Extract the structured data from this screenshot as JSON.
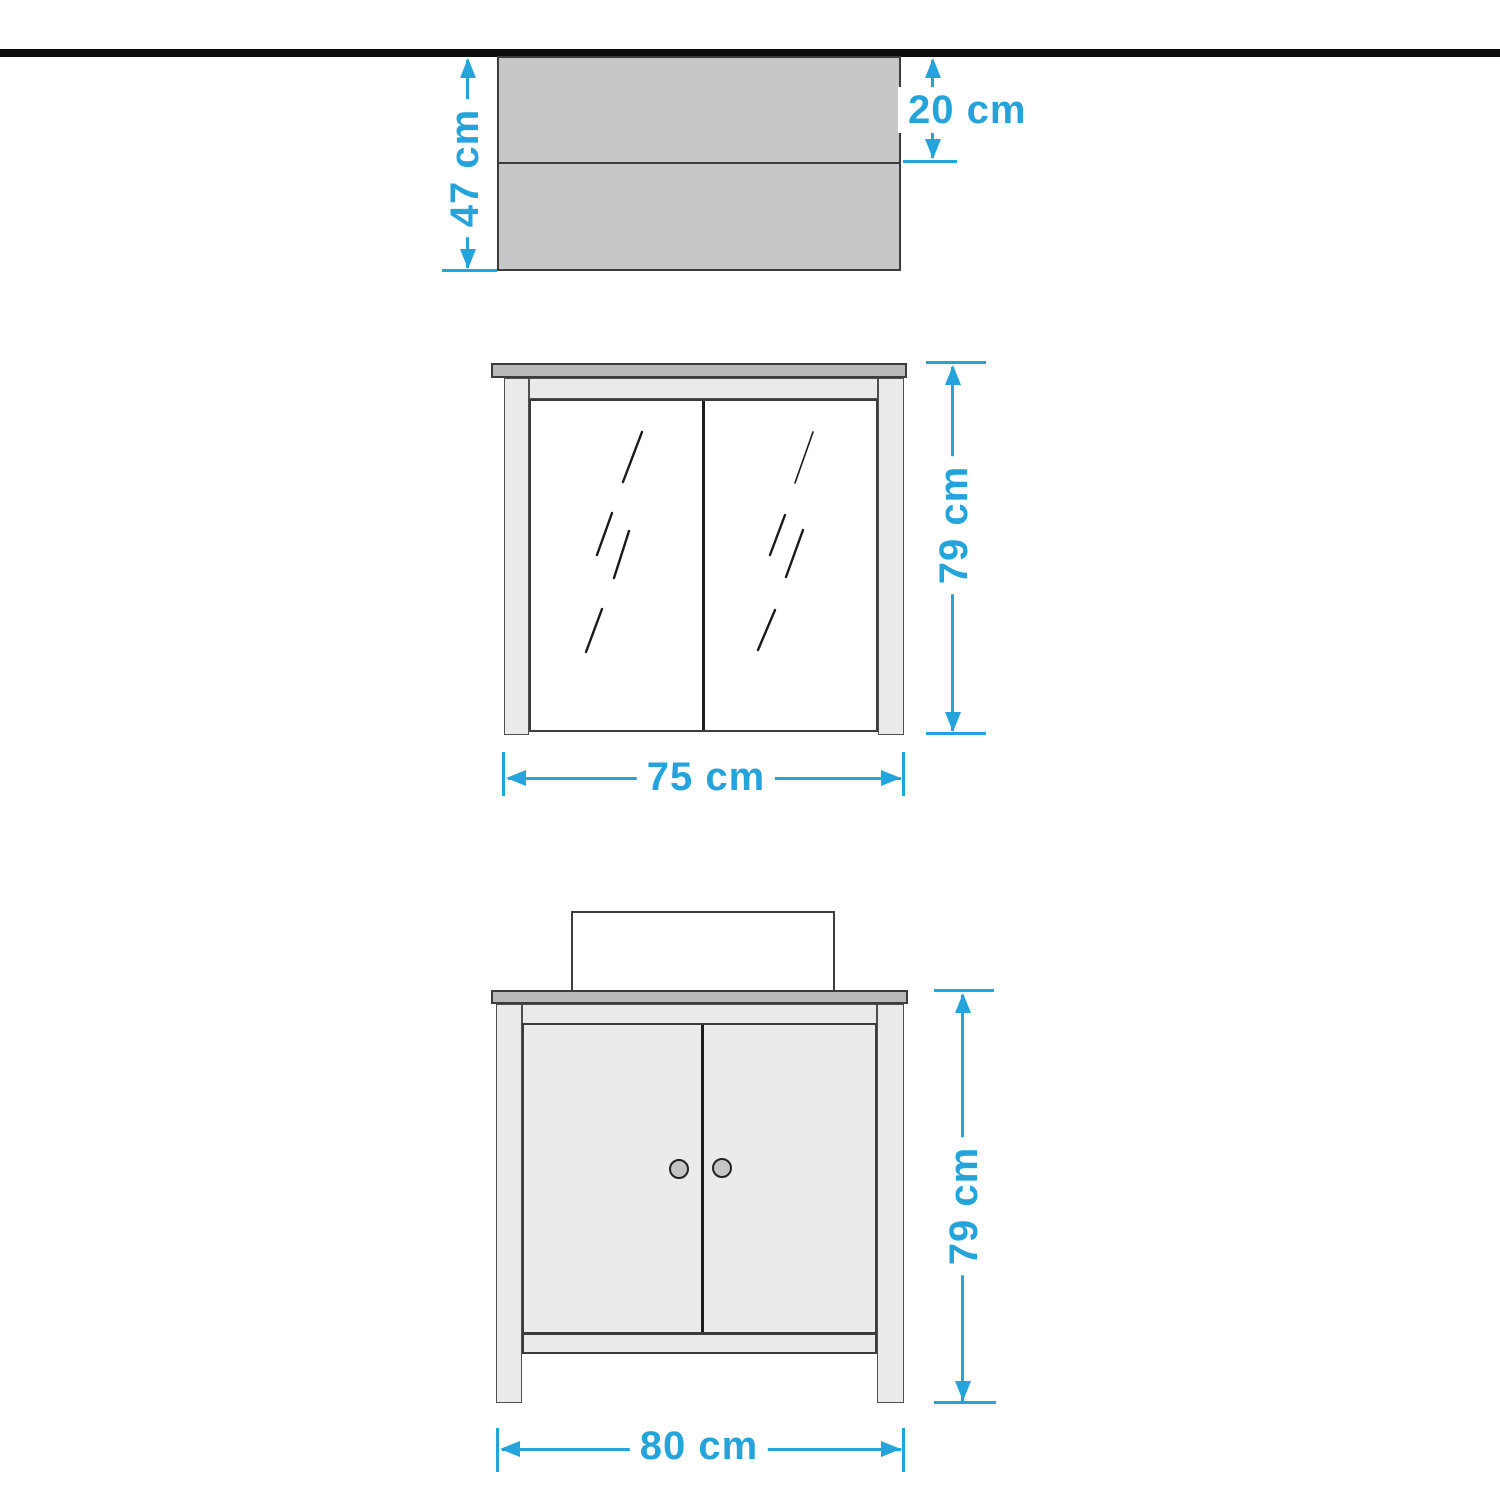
{
  "canvas": {
    "background": "#ffffff"
  },
  "accent_color": "#24a4da",
  "divider_bar_color": "#0d0d0d",
  "figures": {
    "top_view": {
      "description": "cabinet depth top view",
      "depth_total_label": "47 cm",
      "depth_top_label": "20 cm"
    },
    "mirror_cabinet": {
      "description": "mirror wall cabinet front view",
      "height_label": "79 cm",
      "width_label": "75 cm"
    },
    "vanity": {
      "description": "washbasin vanity unit front view",
      "height_label": "79 cm",
      "width_label": "80 cm"
    }
  }
}
